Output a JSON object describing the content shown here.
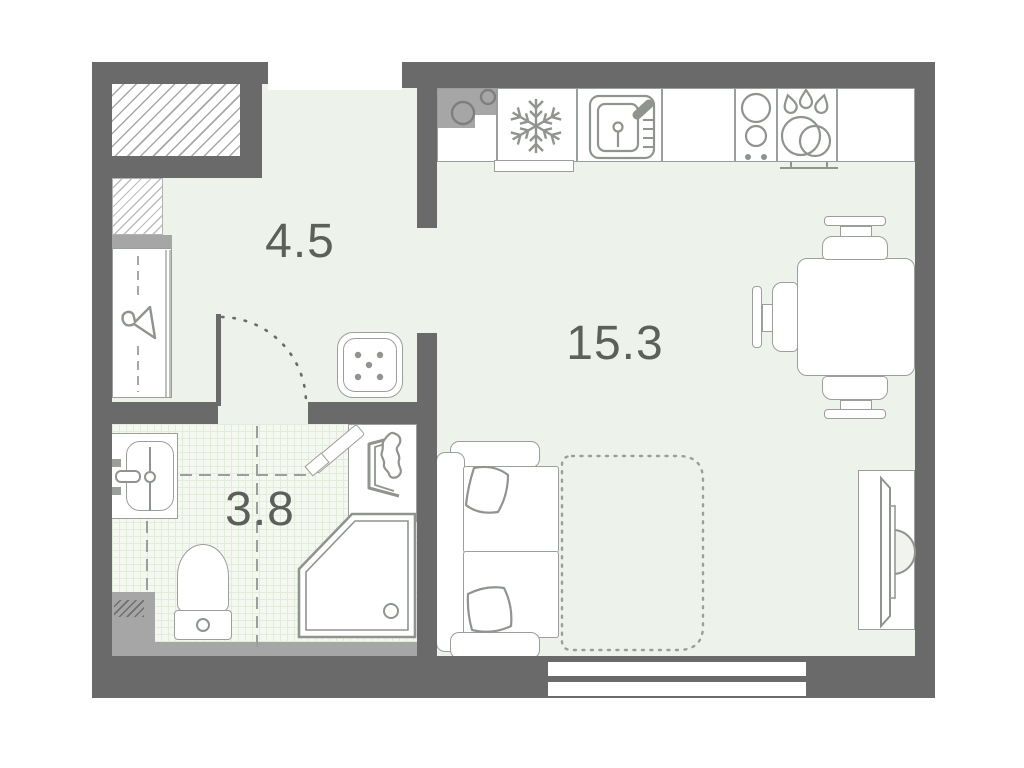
{
  "plan": {
    "type": "studio-apartment-floor-plan",
    "rooms": {
      "hallway": {
        "name": "hallway",
        "area_label": "4.5"
      },
      "living_kitchen": {
        "name": "kitchen-living-room",
        "area_label": "15.3"
      },
      "bathroom": {
        "name": "bathroom",
        "area_label": "3.8"
      }
    },
    "colors": {
      "wall": "#6a6a6a",
      "wall_secondary": "#a6a6a6",
      "floor": "#edf3ea",
      "bathroom_tile_line": "#e2ecda",
      "fixture_outline": "#9b9f9b",
      "label_text": "#5b605a"
    },
    "fixtures": [
      "ventilation-shaft",
      "entrance-opening",
      "wardrobe",
      "bathroom-door",
      "pouf",
      "kitchen-counter",
      "fridge",
      "kitchen-sink",
      "hob",
      "dishes",
      "dining-table",
      "chairs",
      "sofa-bed",
      "bed-fold-out",
      "tv",
      "window",
      "washbasin",
      "toilet",
      "shower",
      "washing-machine",
      "plumbing-block",
      "wall-shelf"
    ]
  }
}
